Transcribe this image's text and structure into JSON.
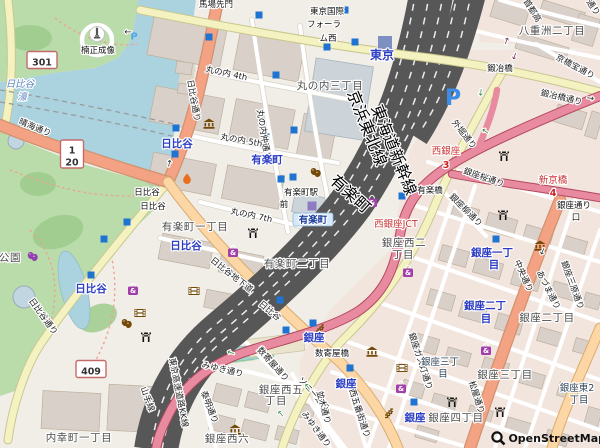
{
  "app": {
    "type": "openstreetmap-view",
    "attribution": "OpenStreetMap"
  },
  "colors": {
    "bg": "#f1eee8",
    "water": "#aad3df",
    "park": "#badcab",
    "building": "#d9d0c9",
    "motorway": "#e88ba0",
    "trunk": "#f3a284",
    "primary": "#fcd6a4",
    "secondary": "#f4f2c0",
    "stationblue": "#2d3ec2",
    "redlabel": "#cc3333",
    "subway_entrance": "#1f74d2",
    "poi_brown": "#734a08",
    "poi_purple": "#a13fab"
  },
  "map": {
    "labels": [
      {
        "t": "馬場先門",
        "x": 216,
        "y": 7,
        "c": "st"
      },
      {
        "t": "丸の内 4th",
        "x": 226,
        "y": 76,
        "r": 12,
        "c": "st"
      },
      {
        "t": "丸の内仲通り",
        "x": 261,
        "y": 135,
        "r": 81,
        "c": "st"
      },
      {
        "t": "丸の内 5th",
        "x": 241,
        "y": 143,
        "r": 10,
        "c": "st"
      },
      {
        "t": "丸の内 7th",
        "x": 251,
        "y": 218,
        "r": 12,
        "c": "st"
      },
      {
        "t": "日比谷通り",
        "x": 191,
        "y": 101,
        "r": 80,
        "c": "st"
      },
      {
        "t": "日比谷通り",
        "x": 41,
        "y": 318,
        "r": 54,
        "c": "st"
      },
      {
        "t": "晴海通り",
        "x": 34,
        "y": 130,
        "r": 22,
        "c": "st"
      },
      {
        "t": "鍛冶橋通り",
        "x": 561,
        "y": 100,
        "r": 13,
        "c": "st"
      },
      {
        "t": "京橋宝通り",
        "x": 574,
        "y": 69,
        "r": 28,
        "c": "st"
      },
      {
        "t": "外堀通り",
        "x": 462,
        "y": 136,
        "r": 52,
        "c": "st"
      },
      {
        "t": "首都高",
        "x": 530,
        "y": 12,
        "r": 58,
        "c": "st"
      },
      {
        "t": "通り",
        "x": 591,
        "y": 9,
        "r": 55,
        "c": "st"
      },
      {
        "t": "銀座桜通り",
        "x": 483,
        "y": 180,
        "r": 19,
        "c": "st"
      },
      {
        "t": "銀座柳通り",
        "x": 464,
        "y": 212,
        "r": 45,
        "c": "st"
      },
      {
        "t": "中央通り",
        "x": 521,
        "y": 277,
        "r": 66,
        "c": "st"
      },
      {
        "t": "あづま通り",
        "x": 546,
        "y": 291,
        "r": 63,
        "c": "st"
      },
      {
        "t": "銀座三原通り",
        "x": 570,
        "y": 286,
        "r": 70,
        "c": "st"
      },
      {
        "t": "銀座ガス灯通り",
        "x": 418,
        "y": 362,
        "r": 72,
        "c": "st"
      },
      {
        "t": "数寄屋通り",
        "x": 271,
        "y": 366,
        "r": 48,
        "c": "st"
      },
      {
        "t": "みゆき通り",
        "x": 222,
        "y": 372,
        "r": 13,
        "c": "st"
      },
      {
        "t": "みゆき通り",
        "x": 314,
        "y": 431,
        "r": 53,
        "c": "st"
      },
      {
        "t": "泰明通り",
        "x": 207,
        "y": 408,
        "r": 69,
        "c": "st"
      },
      {
        "t": "ソニー通り",
        "x": 312,
        "y": 396,
        "r": 48,
        "c": "st"
      },
      {
        "t": "並木通り",
        "x": 321,
        "y": 408,
        "r": 75,
        "c": "st"
      },
      {
        "t": "西五番街通り",
        "x": 357,
        "y": 414,
        "r": 72,
        "c": "st"
      },
      {
        "t": "松屋通り",
        "x": 474,
        "y": 398,
        "r": 72,
        "c": "st"
      },
      {
        "t": "日比谷地下道",
        "x": 230,
        "y": 277,
        "r": 38,
        "c": "st"
      },
      {
        "t": "日比谷",
        "x": 268,
        "y": 313,
        "r": 40,
        "c": "st"
      },
      {
        "t": "山手線",
        "x": 145,
        "y": 400,
        "r": 70,
        "c": "st"
      },
      {
        "t": "東京高速道路KK線",
        "x": 176,
        "y": 393,
        "r": 79,
        "c": "st"
      },
      {
        "t": "東海道新幹線",
        "x": 389,
        "y": 152,
        "r": 68,
        "c": "rl"
      },
      {
        "t": "京浜東北線",
        "x": 362,
        "y": 130,
        "r": 68,
        "c": "rl"
      },
      {
        "t": "有楽町",
        "x": 347,
        "y": 198,
        "r": 42,
        "c": "rl"
      },
      {
        "t": "楠正成像",
        "x": 98,
        "y": 53,
        "c": "poi"
      },
      {
        "t": "有楽町駅",
        "x": 301,
        "y": 195,
        "c": "poi"
      },
      {
        "t": "前",
        "x": 284,
        "y": 207,
        "c": "poi"
      },
      {
        "t": "数寄屋橋",
        "x": 332,
        "y": 356,
        "c": "poi"
      },
      {
        "t": "有楽橋",
        "x": 430,
        "y": 193,
        "c": "poi"
      },
      {
        "t": "鍛冶橋",
        "x": 500,
        "y": 71,
        "c": "poi"
      },
      {
        "t": "銀座通り",
        "x": 574,
        "y": 208,
        "c": "poi"
      },
      {
        "t": "口",
        "x": 576,
        "y": 220,
        "c": "poi"
      },
      {
        "t": "東京国際",
        "x": 327,
        "y": 14,
        "c": "poi"
      },
      {
        "t": "フォーラ",
        "x": 324,
        "y": 27,
        "c": "poi"
      },
      {
        "t": "ム西",
        "x": 328,
        "y": 41,
        "c": "poi"
      },
      {
        "t": "日比谷",
        "x": 147,
        "y": 195,
        "c": "poi"
      },
      {
        "t": "日比谷",
        "x": 153,
        "y": 209,
        "c": "poi"
      },
      {
        "t": "内幸町一丁目",
        "x": 79,
        "y": 441,
        "c": "d"
      },
      {
        "t": "有楽町一丁目",
        "x": 195,
        "y": 230,
        "c": "d"
      },
      {
        "t": "有楽町二丁目",
        "x": 297,
        "y": 267,
        "c": "d"
      },
      {
        "t": "丸の内三丁目",
        "x": 330,
        "y": 89,
        "c": "d"
      },
      {
        "t": "八重洲二丁目",
        "x": 552,
        "y": 34,
        "c": "d"
      },
      {
        "t": "銀座西二",
        "x": 404,
        "y": 246,
        "c": "d"
      },
      {
        "t": "丁目",
        "x": 403,
        "y": 258,
        "c": "d"
      },
      {
        "t": "銀座西五",
        "x": 281,
        "y": 393,
        "c": "d"
      },
      {
        "t": "丁目",
        "x": 276,
        "y": 404,
        "c": "d"
      },
      {
        "t": "銀座西六",
        "x": 227,
        "y": 442,
        "c": "d"
      },
      {
        "t": "銀座二丁目",
        "x": 547,
        "y": 321,
        "c": "d"
      },
      {
        "t": "銀座三丁目",
        "x": 505,
        "y": 378,
        "c": "d"
      },
      {
        "t": "銀座四丁目",
        "x": 456,
        "y": 421,
        "c": "d"
      },
      {
        "t": "公園",
        "x": 10,
        "y": 261,
        "c": "d"
      },
      {
        "t": "銀座三丁",
        "x": 440,
        "y": 365,
        "c": "stp"
      },
      {
        "t": "目",
        "x": 443,
        "y": 377,
        "c": "stp"
      },
      {
        "t": "銀座東2",
        "x": 577,
        "y": 391,
        "c": "stp"
      },
      {
        "t": "丁目",
        "x": 579,
        "y": 403,
        "c": "stp"
      },
      {
        "t": "東京",
        "x": 382,
        "y": 59,
        "c": "sta2"
      },
      {
        "t": "日比谷",
        "x": 177,
        "y": 147,
        "c": "sta"
      },
      {
        "t": "日比谷",
        "x": 186,
        "y": 249,
        "c": "sta"
      },
      {
        "t": "日比谷",
        "x": 91,
        "y": 292,
        "c": "sta"
      },
      {
        "t": "有楽町",
        "x": 267,
        "y": 163,
        "c": "sta"
      },
      {
        "t": "銀座",
        "x": 314,
        "y": 341,
        "c": "sta"
      },
      {
        "t": "銀座",
        "x": 346,
        "y": 387,
        "c": "sta"
      },
      {
        "t": "銀座",
        "x": 415,
        "y": 421,
        "c": "sta"
      },
      {
        "t": "銀座一丁",
        "x": 492,
        "y": 256,
        "c": "sta"
      },
      {
        "t": "目",
        "x": 494,
        "y": 268,
        "c": "sta"
      },
      {
        "t": "銀座二丁",
        "x": 485,
        "y": 309,
        "c": "sta"
      },
      {
        "t": "目",
        "x": 486,
        "y": 322,
        "c": "sta"
      },
      {
        "t": "有楽町",
        "x": 313,
        "y": 223,
        "c": "stab"
      },
      {
        "t": "日比谷",
        "x": 20,
        "y": 87,
        "c": "w"
      },
      {
        "t": "濠",
        "x": 22,
        "y": 100,
        "c": "w"
      },
      {
        "t": "西銀座JCT",
        "x": 396,
        "y": 227,
        "c": "red"
      },
      {
        "t": "西銀座",
        "x": 446,
        "y": 154,
        "c": "red"
      },
      {
        "t": "新京橋",
        "x": 553,
        "y": 183,
        "c": "red"
      },
      {
        "t": "3",
        "x": 446,
        "y": 168,
        "c": "rno"
      },
      {
        "t": "4",
        "x": 553,
        "y": 196,
        "c": "rno"
      },
      {
        "t": "→",
        "x": 128,
        "y": 29,
        "r": 180,
        "c": "arr"
      },
      {
        "t": "→",
        "x": 172,
        "y": 164,
        "r": -78,
        "c": "arr"
      },
      {
        "t": "→",
        "x": 590,
        "y": 101,
        "r": 8,
        "c": "arr"
      },
      {
        "t": "→",
        "x": 540,
        "y": 250,
        "r": 115,
        "c": "arr"
      },
      {
        "t": "→",
        "x": 478,
        "y": 92,
        "r": 95,
        "c": "arrg"
      },
      {
        "t": "→",
        "x": 487,
        "y": 129,
        "r": 215,
        "c": "arrg"
      },
      {
        "t": "→",
        "x": 310,
        "y": 385,
        "r": 235,
        "c": "arrg"
      },
      {
        "t": "→",
        "x": 283,
        "y": 412,
        "r": 230,
        "c": "arrg"
      },
      {
        "t": "→",
        "x": 232,
        "y": 350,
        "r": 200,
        "c": "arrg"
      },
      {
        "t": "→",
        "x": 509,
        "y": 42,
        "r": -70,
        "c": "arrm"
      },
      {
        "t": "→",
        "x": 512,
        "y": 55,
        "r": 110,
        "c": "arrm"
      }
    ],
    "badges": [
      {
        "lines": [
          "301"
        ],
        "x": 42,
        "y": 60,
        "w": 30,
        "h": 17
      },
      {
        "lines": [
          "1",
          "20"
        ],
        "x": 72,
        "y": 154,
        "w": 23,
        "h": 28
      },
      {
        "lines": [
          "409"
        ],
        "x": 91,
        "y": 369,
        "w": 30,
        "h": 17
      }
    ],
    "icons": [
      {
        "type": "subway-entrance",
        "x": 259,
        "y": 15
      },
      {
        "type": "subway-entrance",
        "x": 209,
        "y": 37
      },
      {
        "type": "subway-entrance",
        "x": 345,
        "y": 10
      },
      {
        "type": "subway-entrance",
        "x": 327,
        "y": 47
      },
      {
        "type": "subway-entrance",
        "x": 355,
        "y": 42
      },
      {
        "type": "subway-entrance",
        "x": 276,
        "y": 75
      },
      {
        "type": "subway-entrance",
        "x": 176,
        "y": 128
      },
      {
        "type": "subway-entrance",
        "x": 294,
        "y": 130
      },
      {
        "type": "subway-entrance",
        "x": 266,
        "y": 137
      },
      {
        "type": "subway-entrance",
        "x": 281,
        "y": 179
      },
      {
        "type": "subway-entrance",
        "x": 293,
        "y": 177
      },
      {
        "type": "subway-entrance",
        "x": 175,
        "y": 154
      },
      {
        "type": "subway-entrance",
        "x": 127,
        "y": 222
      },
      {
        "type": "subway-entrance",
        "x": 104,
        "y": 239
      },
      {
        "type": "subway-entrance",
        "x": 91,
        "y": 275
      },
      {
        "type": "subway-entrance",
        "x": 402,
        "y": 196
      },
      {
        "type": "subway-entrance",
        "x": 313,
        "y": 323
      },
      {
        "type": "subway-entrance",
        "x": 350,
        "y": 368
      },
      {
        "type": "subway-entrance",
        "x": 414,
        "y": 402
      },
      {
        "type": "subway-entrance",
        "x": 496,
        "y": 239
      },
      {
        "type": "subway-entrance",
        "x": 286,
        "y": 330
      },
      {
        "type": "subway-entrance",
        "x": 280,
        "y": 300
      },
      {
        "type": "station-square",
        "x": 385,
        "y": 43
      },
      {
        "type": "jr-station-square",
        "x": 312,
        "y": 206
      },
      {
        "type": "parking-small",
        "x": 134,
        "y": 36
      },
      {
        "type": "parking-large",
        "x": 453,
        "y": 97
      },
      {
        "type": "museum",
        "x": 209,
        "y": 124
      },
      {
        "type": "museum",
        "x": 540,
        "y": 246
      },
      {
        "type": "museum",
        "x": 372,
        "y": 352
      },
      {
        "type": "museum",
        "x": 235,
        "y": 430
      },
      {
        "type": "flame",
        "x": 187,
        "y": 179
      },
      {
        "type": "theater",
        "x": 316,
        "y": 172
      },
      {
        "type": "theater",
        "x": 127,
        "y": 323
      },
      {
        "type": "theater-purple",
        "x": 33,
        "y": 256
      },
      {
        "type": "cinema",
        "x": 140,
        "y": 313
      },
      {
        "type": "cinema",
        "x": 194,
        "y": 291
      },
      {
        "type": "cinema",
        "x": 402,
        "y": 368
      },
      {
        "type": "shop-bag",
        "x": 233,
        "y": 252
      },
      {
        "type": "shop-bag",
        "x": 372,
        "y": 202
      },
      {
        "type": "shop-bag",
        "x": 408,
        "y": 272
      },
      {
        "type": "shop-bag",
        "x": 401,
        "y": 388
      },
      {
        "type": "shop-bag",
        "x": 486,
        "y": 350
      },
      {
        "type": "shop-bag",
        "x": 133,
        "y": 290
      },
      {
        "type": "torii",
        "x": 253,
        "y": 233
      },
      {
        "type": "torii",
        "x": 504,
        "y": 156
      },
      {
        "type": "torii",
        "x": 503,
        "y": 215
      },
      {
        "type": "torii",
        "x": 452,
        "y": 402
      },
      {
        "type": "torii",
        "x": 500,
        "y": 412
      },
      {
        "type": "torii",
        "x": 146,
        "y": 337
      },
      {
        "type": "statue",
        "x": 97,
        "y": 34
      },
      {
        "type": "steps",
        "x": 320,
        "y": 328
      },
      {
        "type": "steps",
        "x": 389,
        "y": 412
      }
    ]
  }
}
